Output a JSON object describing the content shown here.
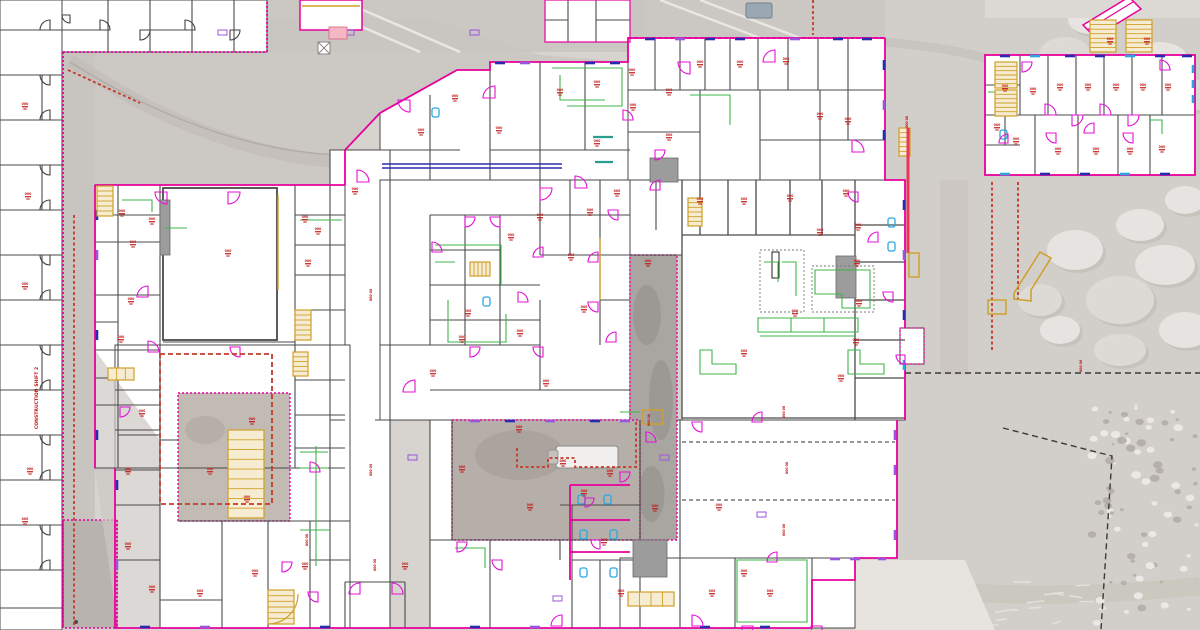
{
  "meta": {
    "view": "campus-floor-plan-overlay",
    "description": "architectural floor plan overlaid on aerial photo",
    "canvas": {
      "width": 1200,
      "height": 630
    }
  },
  "palette": {
    "aerial": "#d7d3cf",
    "road": "#c8c4bf",
    "road_dark": "#b9b4ae",
    "pavement": "#e7e4e0",
    "building": "#ffffff",
    "wall": "#4a4a4a",
    "perimeter": "#e8009c",
    "door": "#e311d6",
    "fixture_green": "#3cb54a",
    "accent_navy": "#2a2ab0",
    "accent_purple": "#9a55dd",
    "accent_cyan": "#2aa7e0",
    "label_red": "#c01616",
    "dashed_red": "#c53a2a",
    "tan": "#cfa028",
    "crimson": "#e8365d",
    "shaft_gray": "#9c9c9c",
    "pink_fill": "#f4b8c4",
    "teal": "#2a9d8f",
    "fence_black": "#3a3a3a"
  },
  "labels": {
    "room_tag": "000",
    "room_tag_sub": "00",
    "corridor_note": "CONSTRUCTION SHIFT 2"
  },
  "floorplan": {
    "room_tags": [
      [
        122,
        212
      ],
      [
        152,
        220
      ],
      [
        133,
        243
      ],
      [
        131,
        300
      ],
      [
        121,
        338
      ],
      [
        228,
        252
      ],
      [
        305,
        218
      ],
      [
        318,
        230
      ],
      [
        308,
        262
      ],
      [
        252,
        420
      ],
      [
        142,
        412
      ],
      [
        128,
        470
      ],
      [
        128,
        545
      ],
      [
        152,
        588
      ],
      [
        200,
        592
      ],
      [
        255,
        572
      ],
      [
        305,
        565
      ],
      [
        210,
        470
      ],
      [
        247,
        498
      ],
      [
        433,
        372
      ],
      [
        468,
        312
      ],
      [
        462,
        338
      ],
      [
        520,
        332
      ],
      [
        546,
        382
      ],
      [
        462,
        468
      ],
      [
        519,
        428
      ],
      [
        584,
        308
      ],
      [
        571,
        256
      ],
      [
        540,
        216
      ],
      [
        511,
        236
      ],
      [
        455,
        97
      ],
      [
        421,
        131
      ],
      [
        499,
        129
      ],
      [
        560,
        91
      ],
      [
        597,
        83
      ],
      [
        633,
        106
      ],
      [
        669,
        91
      ],
      [
        669,
        136
      ],
      [
        632,
        71
      ],
      [
        597,
        142
      ],
      [
        590,
        211
      ],
      [
        617,
        192
      ],
      [
        648,
        262
      ],
      [
        610,
        472
      ],
      [
        604,
        541
      ],
      [
        621,
        592
      ],
      [
        530,
        506
      ],
      [
        584,
        492
      ],
      [
        655,
        507
      ],
      [
        700,
        63
      ],
      [
        740,
        63
      ],
      [
        786,
        60
      ],
      [
        820,
        115
      ],
      [
        848,
        120
      ],
      [
        700,
        200
      ],
      [
        744,
        200
      ],
      [
        790,
        197
      ],
      [
        820,
        231
      ],
      [
        795,
        312
      ],
      [
        744,
        352
      ],
      [
        719,
        506
      ],
      [
        744,
        572
      ],
      [
        712,
        592
      ],
      [
        846,
        192
      ],
      [
        858,
        226
      ],
      [
        857,
        262
      ],
      [
        859,
        302
      ],
      [
        856,
        341
      ],
      [
        841,
        377
      ],
      [
        770,
        592
      ],
      [
        1005,
        87
      ],
      [
        1033,
        90
      ],
      [
        1060,
        86
      ],
      [
        1088,
        86
      ],
      [
        1116,
        86
      ],
      [
        1143,
        86
      ],
      [
        1168,
        86
      ],
      [
        1016,
        140
      ],
      [
        1058,
        150
      ],
      [
        1096,
        150
      ],
      [
        1130,
        150
      ],
      [
        1162,
        148
      ],
      [
        997,
        126
      ],
      [
        1147,
        40
      ],
      [
        1110,
        40
      ],
      [
        25,
        105
      ],
      [
        28,
        195
      ],
      [
        25,
        285
      ],
      [
        30,
        470
      ],
      [
        25,
        520
      ],
      [
        355,
        190
      ],
      [
        405,
        565
      ],
      [
        563,
        462
      ]
    ],
    "room_tags_vertical": [
      [
        785,
        412
      ],
      [
        788,
        468
      ],
      [
        785,
        530
      ],
      [
        908,
        122
      ],
      [
        1082,
        366
      ],
      [
        372,
        295
      ],
      [
        372,
        470
      ],
      [
        376,
        565
      ],
      [
        308,
        540
      ],
      [
        650,
        420
      ]
    ]
  }
}
